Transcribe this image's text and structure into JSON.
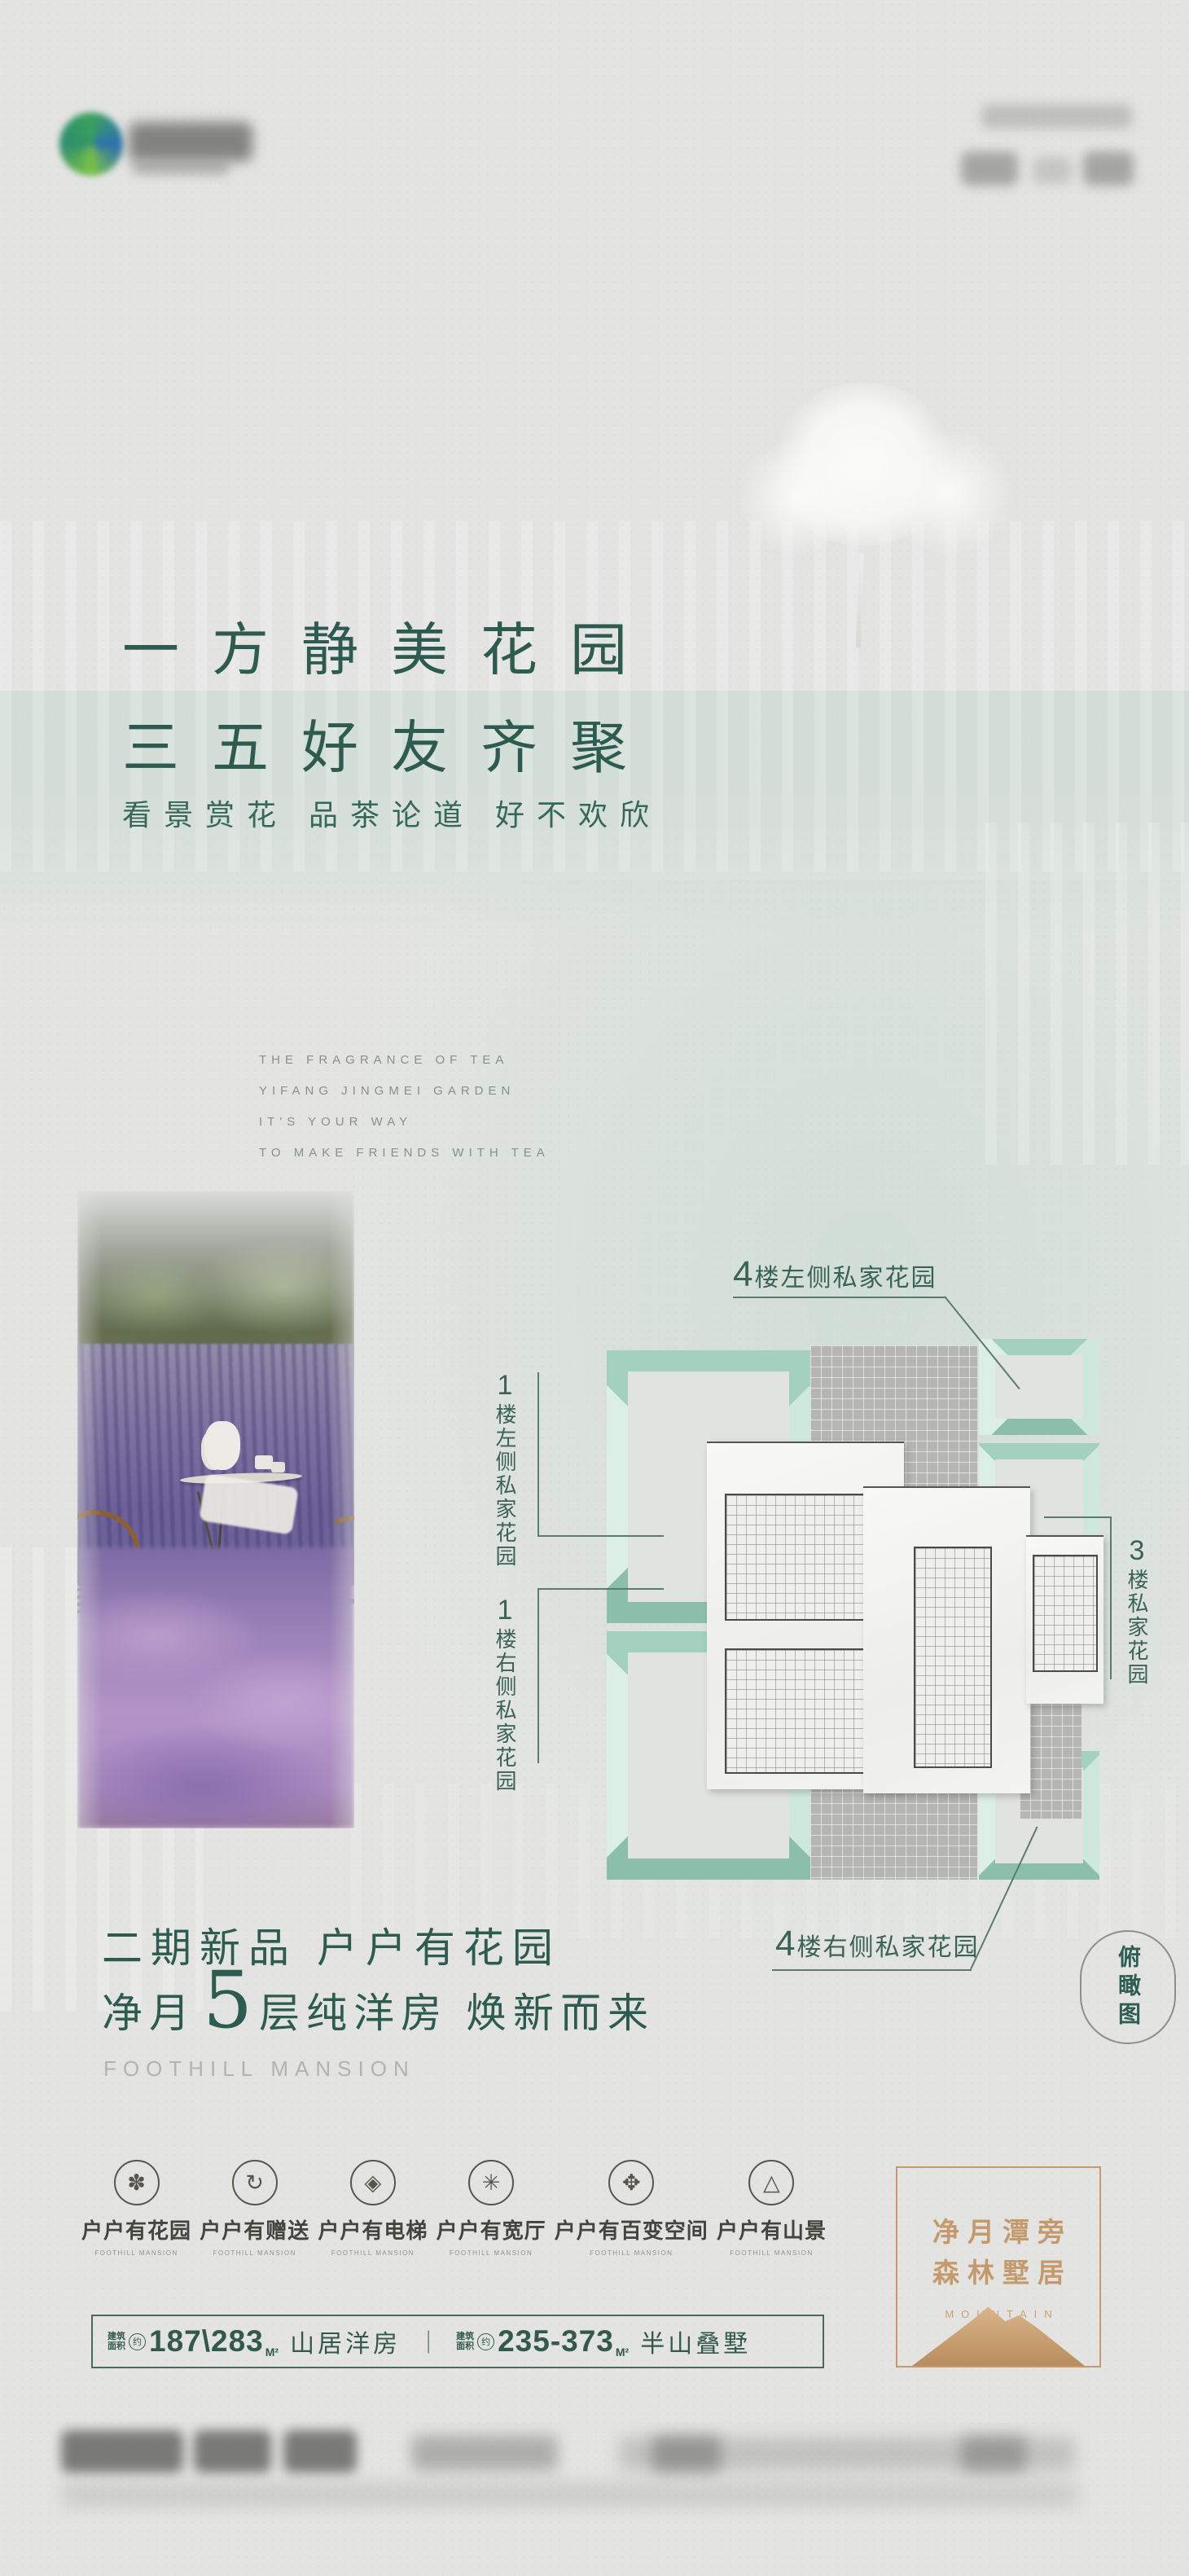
{
  "headline": {
    "line1": "一方静美花园",
    "line2": "三五好友齐聚"
  },
  "subtitle": "看景赏花  品茶论道  好不欢欣",
  "english_intro": {
    "line1": "THE FRAGRANCE OF TEA",
    "line2": "YIFANG JINGMEI GARDEN",
    "line3": "IT'S YOUR WAY",
    "line4": "TO MAKE FRIENDS WITH TEA"
  },
  "plan": {
    "label_top": {
      "num": "4",
      "text": "楼左侧私家花园"
    },
    "label_left1": {
      "num": "1",
      "text": "楼左侧私家花园"
    },
    "label_left2": {
      "num": "1",
      "text": "楼右侧私家花园"
    },
    "label_right": {
      "num": "3",
      "text": "楼私家花园"
    },
    "label_bottom": {
      "num": "4",
      "text": "楼右侧私家花园"
    },
    "badge": "俯瞰图"
  },
  "promo": {
    "line1": "二期新品  户户有花园",
    "line2_prefix": "净月",
    "line2_number": "5",
    "line2_suffix": "层纯洋房 焕新而来",
    "brand_en": "FOOTHILL MANSION"
  },
  "features": [
    {
      "icon": "flower-icon",
      "glyph": "✽",
      "label": "户户有花园",
      "caption": "FOOTHILL MANSION"
    },
    {
      "icon": "cycle-icon",
      "glyph": "↻",
      "label": "户户有赠送",
      "caption": "FOOTHILL MANSION"
    },
    {
      "icon": "lattice-icon",
      "glyph": "◈",
      "label": "户户有电梯",
      "caption": "FOOTHILL MANSION"
    },
    {
      "icon": "snowflake-icon",
      "glyph": "✳",
      "label": "户户有宽厅",
      "caption": "FOOTHILL MANSION"
    },
    {
      "icon": "clover-icon",
      "glyph": "✥",
      "label": "户户有百变空间",
      "caption": "FOOTHILL MANSION"
    },
    {
      "icon": "mountain-tree-icon",
      "glyph": "△",
      "label": "户户有山景",
      "caption": "FOOTHILL MANSION"
    }
  ],
  "specs": {
    "prefix_l1": "建筑",
    "prefix_l2": "面积",
    "approx": "约",
    "value1": "187\\283",
    "unit": "M²",
    "name1": "山居洋房",
    "divider": "｜",
    "value2": "235-373",
    "name2": "半山叠墅"
  },
  "gold_box": {
    "line1": "净月潭旁",
    "line2": "森林墅居",
    "english": "MOUNTAIN"
  },
  "colors": {
    "green": "#2d5b4f",
    "teal": "#8cbfab",
    "gold": "#c49a6c",
    "paper": "#e3e4e2",
    "mint_band": "#c7d9cf"
  }
}
